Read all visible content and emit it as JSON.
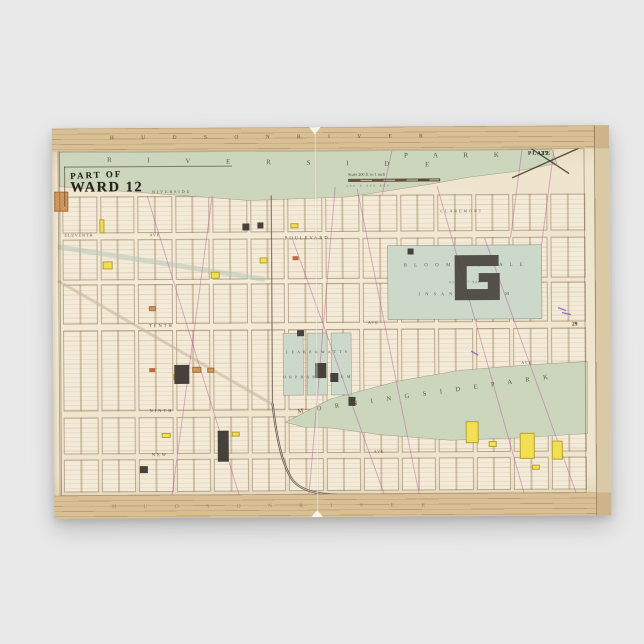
{
  "page": {
    "background_color": "#e9e9e9"
  },
  "map": {
    "title": {
      "line1": "PART OF",
      "line2": "WARD 12"
    },
    "scale": {
      "text": "Scale 200 ft. to 1 inch",
      "bar_numbers": "400   0   400   800"
    },
    "plate": {
      "word": "PLATE",
      "number": "25."
    },
    "adjacent_plate_number": "29",
    "bands": {
      "top_letters": "H U D S O N      R I V E R",
      "bottom_letters": "H U D S O N      R I V E R"
    },
    "parks": {
      "riverside_letters": "R I V E R S I D E",
      "riverside_park_word": "P A R K",
      "morningside": "M O R N I N G S I D E    P A R K",
      "asylum_line1": "B L O O M I N G D A L E",
      "asylum_numbers": "638          1737          904",
      "asylum_line2": "I N S A N E    A S Y L U M",
      "orphan_line1": "L E A K E  &  W A T T S",
      "orphan_line2": "O R P H A N   A S Y L U M"
    },
    "street_labels": [
      {
        "text": "RIVERSIDE",
        "x": 100,
        "y": 61,
        "fs": 4,
        "ls": 2
      },
      {
        "text": "CLAREMONT",
        "x": 388,
        "y": 82,
        "fs": 4,
        "ls": 2
      },
      {
        "text": "ELEVENTH",
        "x": 12,
        "y": 104,
        "fs": 4,
        "ls": 1
      },
      {
        "text": "AVE",
        "x": 97,
        "y": 104,
        "fs": 4,
        "ls": 1
      },
      {
        "text": "BOULEVARD",
        "x": 232,
        "y": 108,
        "fs": 4.5,
        "ls": 2
      },
      {
        "text": "TENTH",
        "x": 96,
        "y": 195,
        "fs": 4.5,
        "ls": 2
      },
      {
        "text": "AVE",
        "x": 315,
        "y": 193,
        "fs": 4,
        "ls": 1
      },
      {
        "text": "NINTH",
        "x": 96,
        "y": 280,
        "fs": 4.5,
        "ls": 2
      },
      {
        "text": "AVE",
        "x": 468,
        "y": 234,
        "fs": 4,
        "ls": 1
      },
      {
        "text": "NEW",
        "x": 98,
        "y": 324,
        "fs": 4.5,
        "ls": 2
      },
      {
        "text": "AVE",
        "x": 320,
        "y": 322,
        "fs": 4,
        "ls": 1
      }
    ],
    "colors": {
      "bg": "#e9e9e9",
      "paper": "#efe5ce",
      "edge": "#d9c9a4",
      "band": "#d8c094",
      "park": "#ccd6bd",
      "asylum": "#cbd8ca",
      "block": "#f3ead7",
      "maroon": "#6e2b20",
      "teal": "#44685c",
      "yellow": "#f2df52",
      "orange": "#d49a5e",
      "redorange": "#c06a3a",
      "dark": "#46413a",
      "magenta": "#b55b9e",
      "purple": "#6f53b0",
      "ink": "#3a3127"
    },
    "geometry": {
      "grid": {
        "col_xs": [
          8,
          46,
          83,
          121,
          158,
          196,
          233,
          271,
          308,
          346,
          383,
          421,
          458,
          496,
          534
        ],
        "rows": [
          {
            "y": 68,
            "h": 37
          },
          {
            "y": 111,
            "h": 41
          },
          {
            "y": 156,
            "h": 40
          },
          {
            "y": 202,
            "h": 81
          },
          {
            "y": 289,
            "h": 37
          },
          {
            "y": 331,
            "h": 33
          }
        ]
      },
      "parks": {
        "riverside_poly": "7,24 500,24 505,38 460,46 417,51 377,58 297,70 197,73 97,65 7,58",
        "morningside_poly": "232,295 277,272 347,254 407,244 477,239 534,236 534,308 467,312 397,314 327,308 277,301 250,300",
        "asylum_rect": [
          335,
          119,
          154,
          74
        ],
        "orphan_blocks": [
          [
            230,
            206,
            20,
            62
          ],
          [
            254,
            206,
            20,
            62
          ],
          [
            278,
            206,
            20,
            62
          ]
        ]
      },
      "buildings": {
        "yellow": [
          [
            47,
            91,
            5,
            14
          ],
          [
            50,
            133,
            10,
            8
          ],
          [
            158,
            144,
            9,
            7
          ],
          [
            207,
            130,
            8,
            6
          ],
          [
            238,
            96,
            8,
            5
          ],
          [
            120,
            246,
            10,
            6
          ],
          [
            108,
            305,
            9,
            5
          ],
          [
            178,
            304,
            8,
            5
          ],
          [
            412,
            295,
            13,
            22
          ],
          [
            466,
            307,
            15,
            26
          ],
          [
            498,
            315,
            11,
            19
          ],
          [
            435,
            315,
            8,
            6
          ],
          [
            478,
            339,
            8,
            5
          ]
        ],
        "orange": [
          [
            2,
            63,
            14,
            20
          ],
          [
            139,
            239,
            9,
            6
          ],
          [
            154,
            240,
            7,
            5
          ],
          [
            96,
            178,
            7,
            5
          ]
        ],
        "red": [
          [
            240,
            129,
            6,
            4
          ],
          [
            96,
            240,
            6,
            4
          ]
        ],
        "dark": [
          [
            121,
            237,
            15,
            19
          ],
          [
            164,
            303,
            11,
            31
          ],
          [
            262,
            236,
            11,
            15
          ],
          [
            277,
            246,
            8,
            9
          ],
          [
            355,
            122,
            6,
            6
          ],
          [
            244,
            203,
            7,
            6
          ],
          [
            190,
            96,
            7,
            7
          ],
          [
            295,
            270,
            7,
            9
          ],
          [
            86,
            338,
            8,
            7
          ],
          [
            205,
            95,
            6,
            6
          ]
        ],
        "asylum_g_path": "M402 129 h44 v11 h-32 v23 h21 v-7 h-9 v-9 h21 v27 h-45 z"
      },
      "lines": {
        "maroon_top": "M0 20.5 H557",
        "teal_top": "M240 22 H557",
        "maroon_bottom": "M0 369 H557",
        "teal_bottom": "M240 370.5 H557",
        "rail_vertical": "M219 68 V276",
        "rail_curve": "M219 276 C223 312 228 336 238 352 C248 366 270 368 300 369 H532",
        "old_road": "M5 118 L212 152",
        "bloomingdale_road": "M5 152 L219 277",
        "magenta": [
          "M95 68 L185 367",
          "M160 68 L118 367",
          "M283 60 L255 367",
          "M305 62 L365 367",
          "M385 60 L470 367",
          "M432 112 L522 367",
          "M470 24 L458 112",
          "M502 24 L489 119",
          "M340 24 L330 68",
          "M240 112 L330 367"
        ],
        "purple": [
          "M505 182 l8 3",
          "M509 187 l9 2",
          "M418 225 l7 4"
        ],
        "plate_x": [
          "M460 52 L533 20",
          "M472 18 L517 48"
        ]
      }
    }
  }
}
